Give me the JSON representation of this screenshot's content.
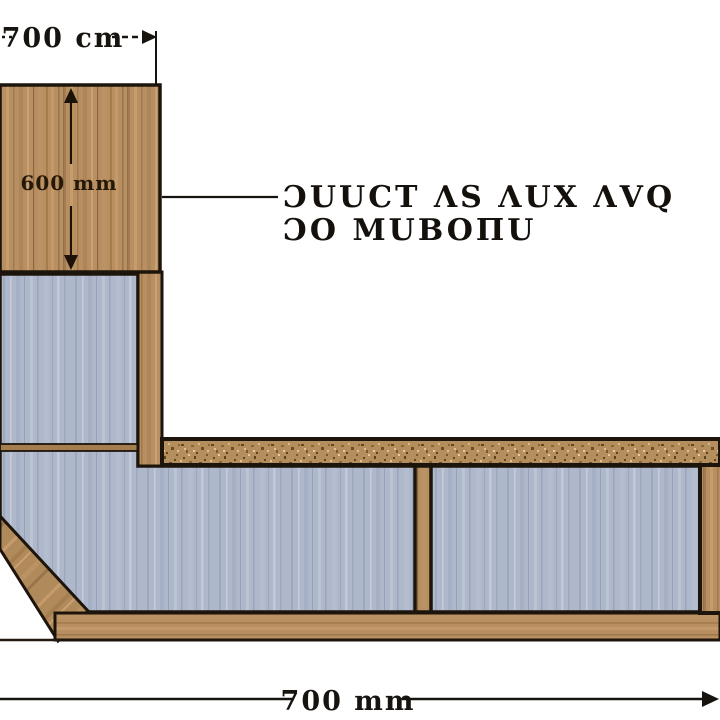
{
  "diagram": {
    "kind": "construction cross-section detail",
    "dimensions": {
      "top_width": "700 cm",
      "column_height": "600 mm",
      "overall_width": "700 mm"
    },
    "callout": {
      "line1": "ƆUUCT ΛS ΛUX ΛVQ",
      "line2": "ƆO MUBOΠU"
    },
    "colors": {
      "background": "#ffffff",
      "outline": "#1d140b",
      "wood_base": "#b78f60",
      "wood_dark": "#8f6c44",
      "wood_light": "#c9a172",
      "panel_blue": "#afb8cb",
      "panel_blue_dark": "#8e99b1",
      "panel_blue_light": "#c5ccda",
      "speckle_base": "#b48e5c",
      "speckle_dark": "#5e431f",
      "joint": "#a57e50",
      "dimension_text": "#17130e"
    }
  }
}
